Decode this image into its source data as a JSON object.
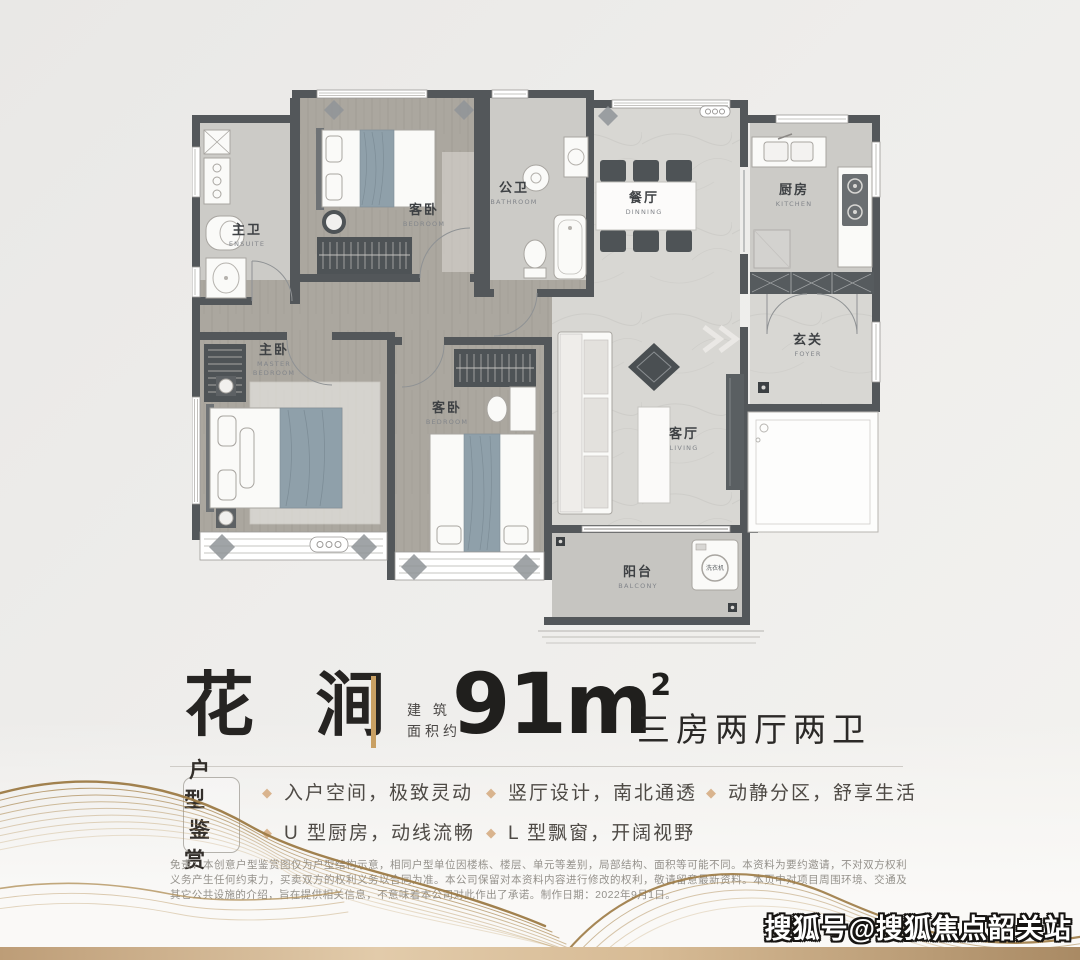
{
  "title": {
    "name": "花 涧",
    "area_prefix_line1": "建 筑",
    "area_prefix_line2": "面积约",
    "area_value": "91m",
    "area_sup": "2",
    "layout": "三房两厅两卫"
  },
  "badge": {
    "line1": "户 型",
    "line2": "鉴 赏"
  },
  "features": [
    {
      "icon": "◆",
      "text": "入户空间，极致灵动"
    },
    {
      "icon": "◆",
      "text": "U 型厨房，动线流畅"
    },
    {
      "icon": "◆",
      "text": "竖厅设计，南北通透"
    },
    {
      "icon": "◆",
      "text": "L 型飘窗，开阔视野"
    },
    {
      "icon": "◆",
      "text": "动静分区，舒享生活"
    }
  ],
  "disclaimer": "免责：本创意户型鉴赏图仅为户型结构示意，相同户型单位因楼栋、楼层、单元等差别，局部结构、面积等可能不同。本资料为要约邀请，不对双方权利义务产生任何约束力，买卖双方的权利义务以合同为准。本公司保留对本资料内容进行修改的权利，敬请留意最新资料。本页中对项目周围环境、交通及其它公共设施的介绍，旨在提供相关信息，不意味着本公司对此作出了承诺。制作日期：2022年9月1日。",
  "watermark": "搜狐号@搜狐焦点韶关站",
  "floorplan": {
    "rooms": [
      {
        "zh": "主卫",
        "en": "ENSUITE"
      },
      {
        "zh": "客卧",
        "en": "BEDROOM"
      },
      {
        "zh": "公卫",
        "en": "BATHROOM"
      },
      {
        "zh": "餐厅",
        "en": "DINNING"
      },
      {
        "zh": "厨房",
        "en": "KITCHEN"
      },
      {
        "zh": "玄关",
        "en": "FOYER"
      },
      {
        "zh": "主卧",
        "en1": "MASTER",
        "en2": "BEDROOM"
      },
      {
        "zh": "客卧",
        "en": "BEDROOM"
      },
      {
        "zh": "客厅",
        "en": "LIVING"
      },
      {
        "zh": "阳台",
        "en": "BALCONY"
      }
    ],
    "washer_label": "洗衣机"
  },
  "colors": {
    "accent_gold": "#c9a063",
    "bullet_diamond": "#d9b48e",
    "wall": "#53575a",
    "bottom_band": "#d7bb95",
    "blanket_blue": "#8fa0aa"
  }
}
